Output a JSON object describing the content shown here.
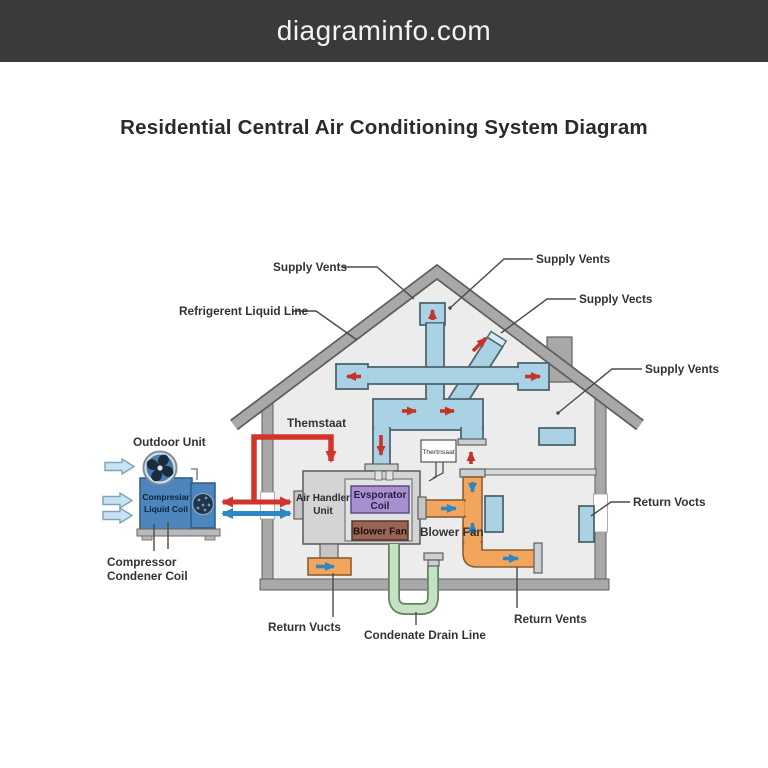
{
  "header": {
    "site": "diagraminfo.com"
  },
  "title": "Residential Central Air Conditioning System Diagram",
  "labels": {
    "supply_vents_top_left": "Supply Vents",
    "supply_vents_top_right": "Supply Vents",
    "supply_vects_right": "Supply Vects",
    "supply_vents_far_right": "Supply Vents",
    "refrigerant_line": "Refrigerent Liquid Line",
    "thermostat": "Themstaat",
    "outdoor_unit": "Outdoor Unit",
    "compressor_line1": "Compressor",
    "compressor_line2": "Condener Coil",
    "return_vucts": "Return Vucts",
    "condensate_drain": "Condenate Drain Line",
    "return_vents": "Return Vents",
    "return_vocts": "Return Vocts",
    "blower_fan_ext": "Blower Fan"
  },
  "components": {
    "air_handler_line1": "Air Handler",
    "air_handler_line2": "Unit",
    "evaporator_line1": "Evsporator",
    "evaporator_line2": "Coil",
    "blower_fan_box": "Blower Fan",
    "thermostat_box": "Thertnsaat",
    "compressor_box_line1": "Compresiar",
    "compressor_box_line2": "Liquid Coil"
  },
  "colors": {
    "header_bg": "#3b3a39",
    "duct_blue": "#a9d2e4",
    "return_orange": "#f2a55c",
    "supply_arrow_red": "#c4342b",
    "refrigerant_red": "#d2342c",
    "refrigerant_blue": "#2f86c5",
    "drain_green": "#c5e2c5",
    "evaporator_purple": "#a78fd0",
    "blower_brown": "#9c6454",
    "unit_blue": "#4c86bc",
    "wall_gray": "#a8a8a8"
  }
}
